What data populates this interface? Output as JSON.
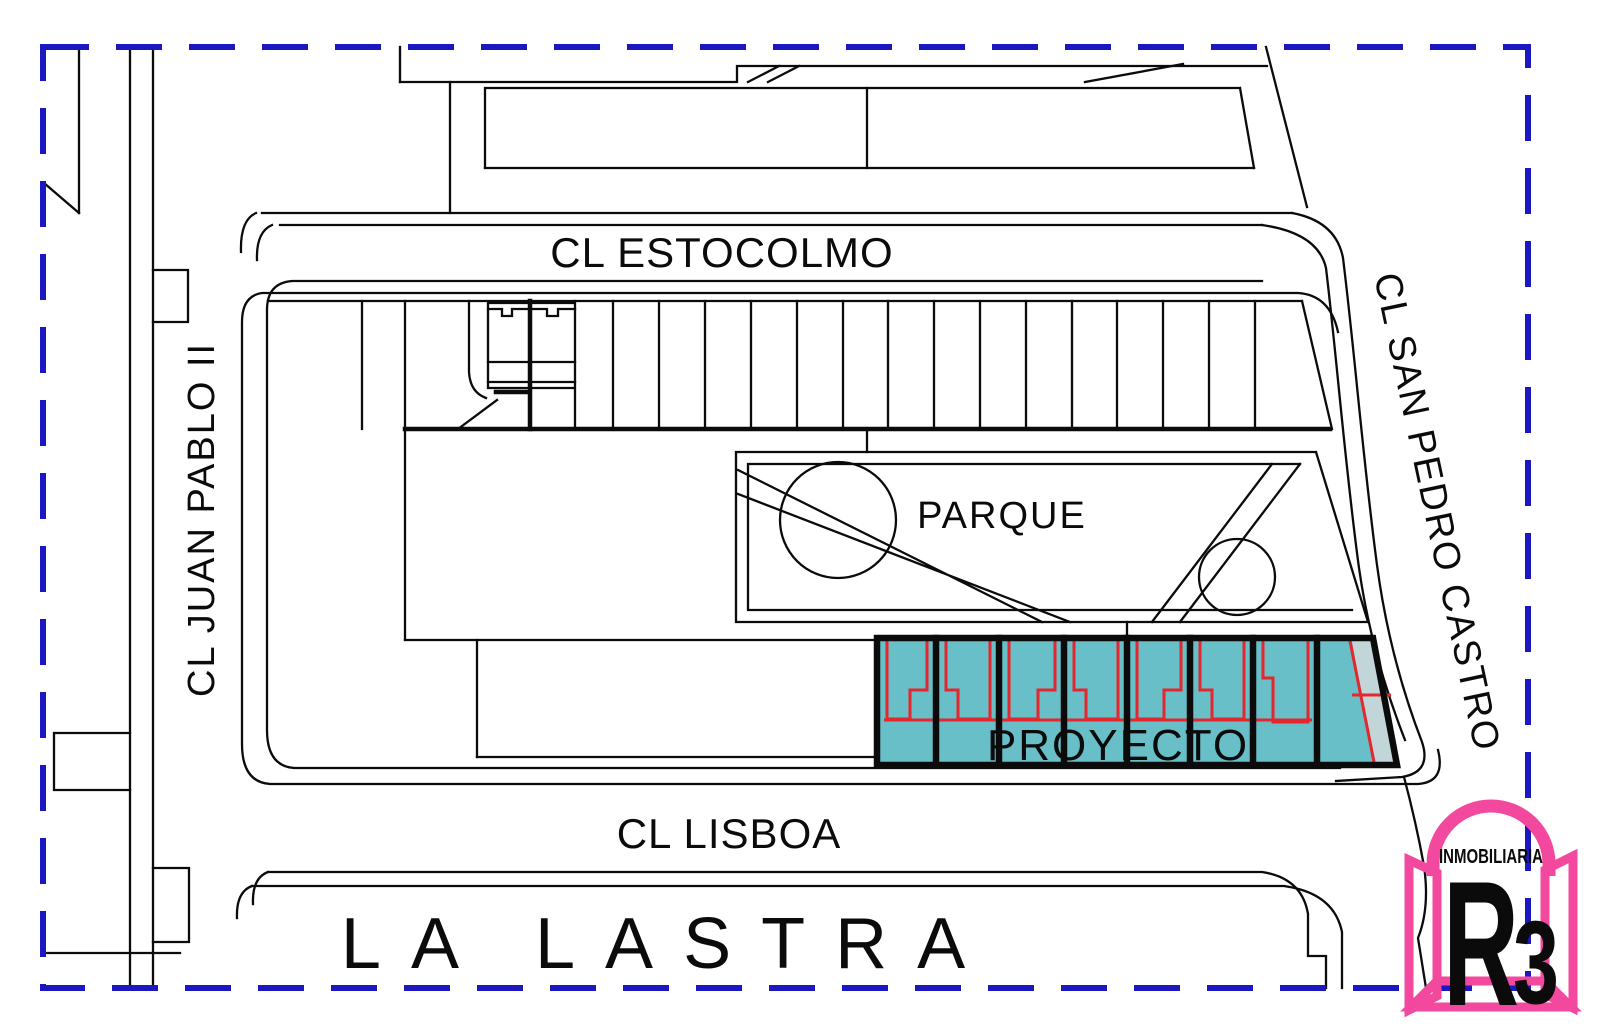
{
  "plan": {
    "type": "site-location-plan",
    "boundary_style": "dashed",
    "streets": {
      "top": "CL ESTOCOLMO",
      "left": "CL JUAN PABLO II",
      "right": "CL SAN PEDRO CASTRO",
      "bottom": "CL LISBOA"
    },
    "areas": {
      "park": "PARQUE",
      "project": "PROYECTO",
      "district": "LA LASTRA"
    },
    "project_parcels": 8
  },
  "logo": {
    "brand": "INMOBILIARIA",
    "mark_r": "R",
    "mark_3": "3"
  },
  "colors": {
    "boundary_navy": "#1C18C0",
    "parcel_teal": "#68BFC7",
    "parcel_teal_light": "#C2D6DA",
    "outline_red": "#E5262C",
    "district_red": "#EE1111",
    "logo_pink": "#F2499F",
    "logo_blue": "#5484C4",
    "line_black": "#0B0B0B"
  }
}
